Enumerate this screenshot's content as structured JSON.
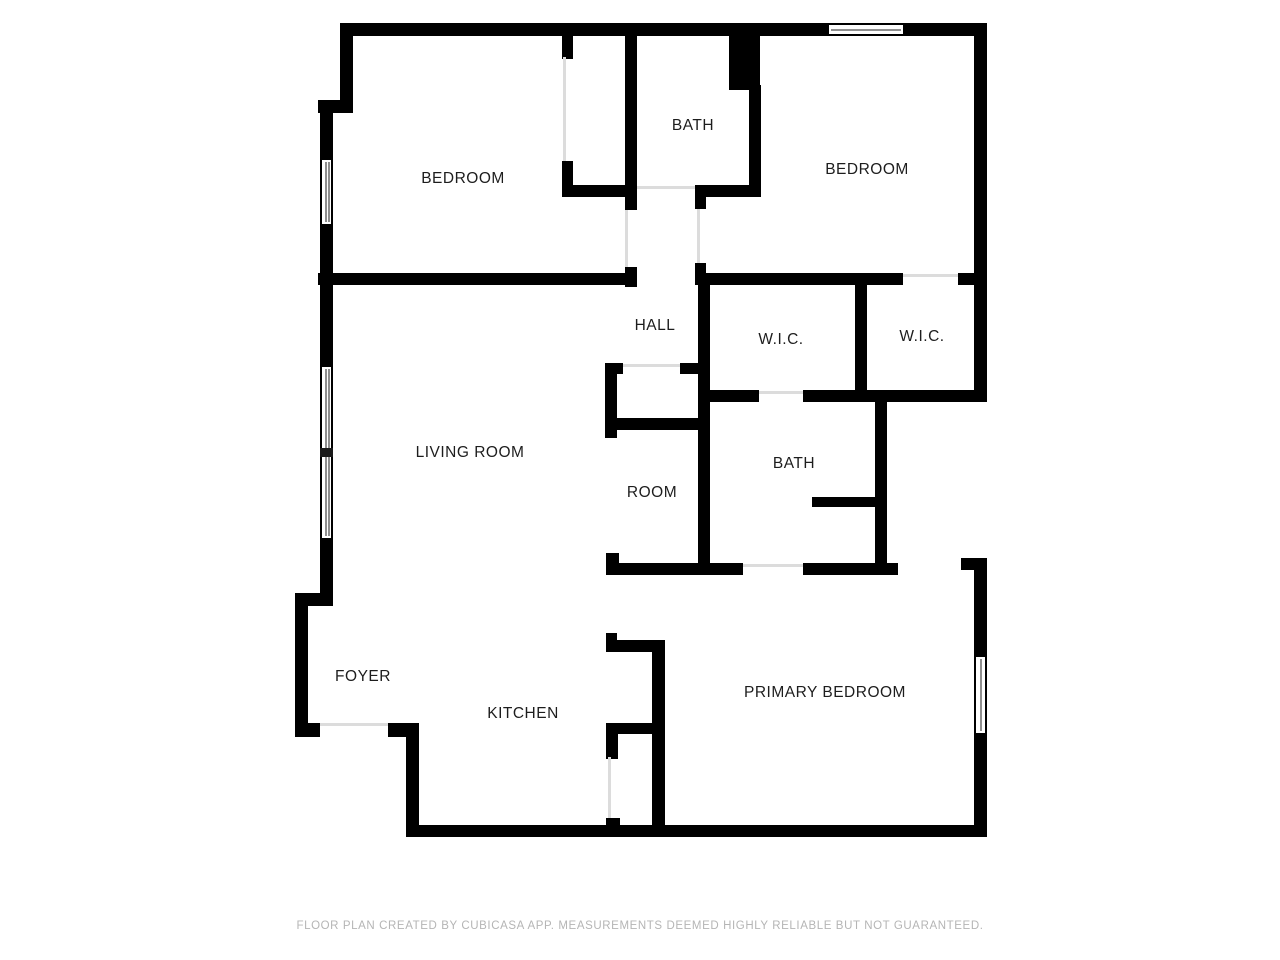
{
  "page": {
    "width": 1280,
    "height": 960,
    "background": "#ffffff"
  },
  "colors": {
    "wall": "#000000",
    "door_line": "#dcdcdc",
    "window_pane": "#8f8f8f",
    "label": "#1d1d1d",
    "footer": "#b5b5b5"
  },
  "footer": {
    "disclaimer": "FLOOR PLAN CREATED BY CUBICASA APP. MEASUREMENTS DEEMED HIGHLY RELIABLE BUT NOT GUARANTEED.",
    "x": 640,
    "y": 926
  },
  "rooms": [
    {
      "name": "bedroom-1",
      "label": "BEDROOM",
      "x": 463,
      "y": 179
    },
    {
      "name": "bath-1",
      "label": "BATH",
      "x": 693,
      "y": 126
    },
    {
      "name": "bedroom-2",
      "label": "BEDROOM",
      "x": 867,
      "y": 170
    },
    {
      "name": "hall",
      "label": "HALL",
      "x": 655,
      "y": 326
    },
    {
      "name": "wic-left",
      "label": "W.I.C.",
      "x": 781,
      "y": 340
    },
    {
      "name": "wic-right",
      "label": "W.I.C.",
      "x": 922,
      "y": 337
    },
    {
      "name": "living-room",
      "label": "LIVING ROOM",
      "x": 470,
      "y": 453
    },
    {
      "name": "room",
      "label": "ROOM",
      "x": 652,
      "y": 493
    },
    {
      "name": "bath-2",
      "label": "BATH",
      "x": 794,
      "y": 464
    },
    {
      "name": "foyer",
      "label": "FOYER",
      "x": 363,
      "y": 677
    },
    {
      "name": "kitchen",
      "label": "KITCHEN",
      "x": 523,
      "y": 714
    },
    {
      "name": "primary-bedroom",
      "label": "PRIMARY BEDROOM",
      "x": 825,
      "y": 693
    }
  ],
  "walls": [
    {
      "name": "top-wall-left",
      "x": 340,
      "y": 23,
      "w": 487,
      "h": 13
    },
    {
      "name": "top-wall-right",
      "x": 905,
      "y": 23,
      "w": 82,
      "h": 13
    },
    {
      "name": "right-wall-upper",
      "x": 974,
      "y": 23,
      "w": 13,
      "h": 379
    },
    {
      "name": "wic-right-bottom-wall",
      "x": 855,
      "y": 390,
      "w": 132,
      "h": 12
    },
    {
      "name": "right-wall-corner-cap",
      "x": 961,
      "y": 558,
      "w": 26,
      "h": 12
    },
    {
      "name": "right-wall-mid",
      "x": 974,
      "y": 558,
      "w": 13,
      "h": 97
    },
    {
      "name": "right-wall-lower",
      "x": 974,
      "y": 735,
      "w": 13,
      "h": 102
    },
    {
      "name": "bottom-wall",
      "x": 408,
      "y": 825,
      "w": 579,
      "h": 12
    },
    {
      "name": "left-wall-top",
      "x": 340,
      "y": 23,
      "w": 13,
      "h": 82
    },
    {
      "name": "left-wall-step-top",
      "x": 318,
      "y": 100,
      "w": 35,
      "h": 13
    },
    {
      "name": "left-wall-upper",
      "x": 320,
      "y": 100,
      "w": 13,
      "h": 58
    },
    {
      "name": "left-wall-mid",
      "x": 320,
      "y": 226,
      "w": 13,
      "h": 139
    },
    {
      "name": "left-wall-lower",
      "x": 320,
      "y": 540,
      "w": 13,
      "h": 58
    },
    {
      "name": "left-wall-step-bottom",
      "x": 295,
      "y": 593,
      "w": 38,
      "h": 13
    },
    {
      "name": "foyer-left-wall",
      "x": 295,
      "y": 604,
      "w": 13,
      "h": 133
    },
    {
      "name": "foyer-bottom-wall-left",
      "x": 295,
      "y": 723,
      "w": 25,
      "h": 14
    },
    {
      "name": "foyer-bottom-wall-right",
      "x": 388,
      "y": 723,
      "w": 30,
      "h": 14
    },
    {
      "name": "kitchen-left-wall",
      "x": 406,
      "y": 723,
      "w": 13,
      "h": 114
    },
    {
      "name": "closet1-left-wall-top",
      "x": 562,
      "y": 33,
      "w": 11,
      "h": 26
    },
    {
      "name": "closet1-left-wall-bottom",
      "x": 562,
      "y": 161,
      "w": 11,
      "h": 36
    },
    {
      "name": "closet1-bottom-wall",
      "x": 562,
      "y": 185,
      "w": 75,
      "h": 12
    },
    {
      "name": "closet1-right-wall",
      "x": 625,
      "y": 33,
      "w": 12,
      "h": 177
    },
    {
      "name": "bedroom1-door-jamb",
      "x": 625,
      "y": 267,
      "w": 12,
      "h": 20
    },
    {
      "name": "bedroom1-bottom-wall",
      "x": 318,
      "y": 273,
      "w": 315,
      "h": 12
    },
    {
      "name": "bath1-wall-chunk",
      "x": 729,
      "y": 33,
      "w": 31,
      "h": 57
    },
    {
      "name": "bath1-right-wall",
      "x": 749,
      "y": 85,
      "w": 12,
      "h": 112
    },
    {
      "name": "bath1-bottom-wall",
      "x": 695,
      "y": 185,
      "w": 66,
      "h": 12
    },
    {
      "name": "hall-bed2-jamb-upper",
      "x": 695,
      "y": 185,
      "w": 11,
      "h": 24
    },
    {
      "name": "hall-bed2-jamb-lower",
      "x": 695,
      "y": 263,
      "w": 11,
      "h": 22
    },
    {
      "name": "bedroom2-bottom-wall",
      "x": 700,
      "y": 273,
      "w": 203,
      "h": 12
    },
    {
      "name": "bedroom2-bottom-wall-end",
      "x": 958,
      "y": 273,
      "w": 17,
      "h": 12
    },
    {
      "name": "wic-divider-wall",
      "x": 855,
      "y": 283,
      "w": 12,
      "h": 110
    },
    {
      "name": "hall-room-right-wall",
      "x": 698,
      "y": 283,
      "w": 12,
      "h": 292
    },
    {
      "name": "wic-left-bottom-wall-a",
      "x": 698,
      "y": 390,
      "w": 61,
      "h": 12
    },
    {
      "name": "wic-left-bottom-wall-b",
      "x": 803,
      "y": 390,
      "w": 54,
      "h": 12
    },
    {
      "name": "hall-closet-jamb-left",
      "x": 605,
      "y": 363,
      "w": 18,
      "h": 11
    },
    {
      "name": "hall-closet-jamb-right",
      "x": 680,
      "y": 363,
      "w": 19,
      "h": 11
    },
    {
      "name": "hall-closet-left-wall",
      "x": 605,
      "y": 363,
      "w": 12,
      "h": 75
    },
    {
      "name": "hall-closet-bottom-wall",
      "x": 605,
      "y": 418,
      "w": 95,
      "h": 12
    },
    {
      "name": "bath2-partition",
      "x": 812,
      "y": 497,
      "w": 63,
      "h": 10
    },
    {
      "name": "bath2-right-wall",
      "x": 875,
      "y": 390,
      "w": 12,
      "h": 183
    },
    {
      "name": "room-bottom-cap",
      "x": 606,
      "y": 553,
      "w": 13,
      "h": 22
    },
    {
      "name": "room-bottom-wall",
      "x": 610,
      "y": 563,
      "w": 133,
      "h": 12
    },
    {
      "name": "primary-top-wall",
      "x": 803,
      "y": 563,
      "w": 95,
      "h": 12
    },
    {
      "name": "kitchen-nook-cap-top",
      "x": 606,
      "y": 633,
      "w": 11,
      "h": 19
    },
    {
      "name": "kitchen-nook-top-wall",
      "x": 606,
      "y": 640,
      "w": 58,
      "h": 12
    },
    {
      "name": "kitchen-primary-wall",
      "x": 652,
      "y": 640,
      "w": 13,
      "h": 197
    },
    {
      "name": "kitchen-nook-bottom-wall",
      "x": 606,
      "y": 723,
      "w": 49,
      "h": 11
    },
    {
      "name": "kitchen-nook-cap-bottom",
      "x": 606,
      "y": 723,
      "w": 12,
      "h": 36
    },
    {
      "name": "kitchen-door-jamb",
      "x": 606,
      "y": 818,
      "w": 14,
      "h": 19
    }
  ],
  "doors": [
    {
      "name": "closet1-door-opening",
      "x": 563,
      "y": 57,
      "w": 3,
      "h": 104
    },
    {
      "name": "bedroom1-door-opening",
      "x": 625,
      "y": 210,
      "w": 3,
      "h": 57
    },
    {
      "name": "bath1-door-opening",
      "x": 637,
      "y": 186,
      "w": 58,
      "h": 3
    },
    {
      "name": "bedroom2-door-opening",
      "x": 697,
      "y": 209,
      "w": 3,
      "h": 54
    },
    {
      "name": "wic-right-door-opening",
      "x": 903,
      "y": 274,
      "w": 55,
      "h": 3
    },
    {
      "name": "wic-left-door-opening",
      "x": 759,
      "y": 391,
      "w": 44,
      "h": 3
    },
    {
      "name": "hall-closet-door-opening",
      "x": 623,
      "y": 364,
      "w": 57,
      "h": 3
    },
    {
      "name": "bath2-door-opening",
      "x": 743,
      "y": 564,
      "w": 60,
      "h": 3
    },
    {
      "name": "primary-door-opening",
      "x": 608,
      "y": 757,
      "w": 3,
      "h": 61
    },
    {
      "name": "entry-door-opening",
      "x": 320,
      "y": 723,
      "w": 68,
      "h": 3
    }
  ],
  "windows": [
    {
      "name": "window-bedroom2-top",
      "x": 825,
      "y": 23,
      "w": 82,
      "h": 13,
      "orient": "h",
      "panes": 1,
      "dividers": []
    },
    {
      "name": "window-bedroom1-left",
      "x": 320,
      "y": 156,
      "w": 13,
      "h": 72,
      "orient": "v",
      "panes": 2,
      "dividers": []
    },
    {
      "name": "window-living-left",
      "x": 320,
      "y": 363,
      "w": 13,
      "h": 179,
      "orient": "v",
      "panes": 2,
      "dividers": [
        0.475
      ]
    },
    {
      "name": "window-primary-right",
      "x": 974,
      "y": 653,
      "w": 13,
      "h": 84,
      "orient": "v",
      "panes": 1,
      "dividers": []
    }
  ]
}
